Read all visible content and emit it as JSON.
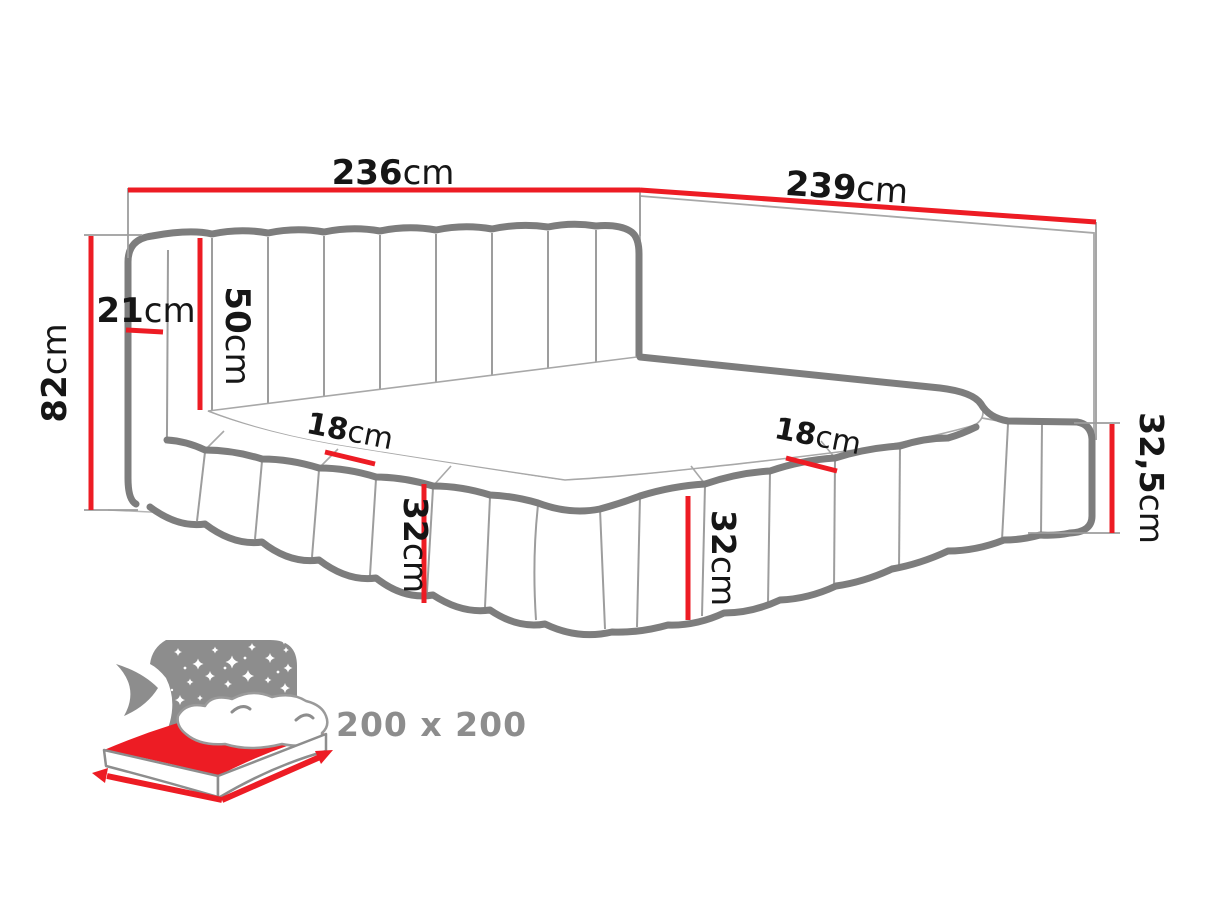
{
  "diagram": {
    "labels": {
      "back_width": {
        "value": "236",
        "unit": "cm"
      },
      "side_length": {
        "value": "239",
        "unit": "cm"
      },
      "total_height": {
        "value": "82",
        "unit": "cm"
      },
      "headboard_depth": {
        "value": "21",
        "unit": "cm"
      },
      "headboard_height": {
        "value": "50",
        "unit": "cm"
      },
      "left_rail_width": {
        "value": "18",
        "unit": "cm"
      },
      "front_rail_width": {
        "value": "18",
        "unit": "cm"
      },
      "left_rail_height": {
        "value": "32",
        "unit": "cm"
      },
      "front_rail_height": {
        "value": "32",
        "unit": "cm"
      },
      "right_rail_height": {
        "value": "32,5",
        "unit": "cm"
      }
    },
    "mattress_size_label": "200 x 200",
    "colors": {
      "dimension_red": "#ed1c24",
      "outline_gray": "#7d7d7d",
      "inner_line_gray": "#9d9d9d",
      "icon_gray": "#8d8d8d",
      "label_text": "#161616",
      "background": "#ffffff"
    }
  }
}
